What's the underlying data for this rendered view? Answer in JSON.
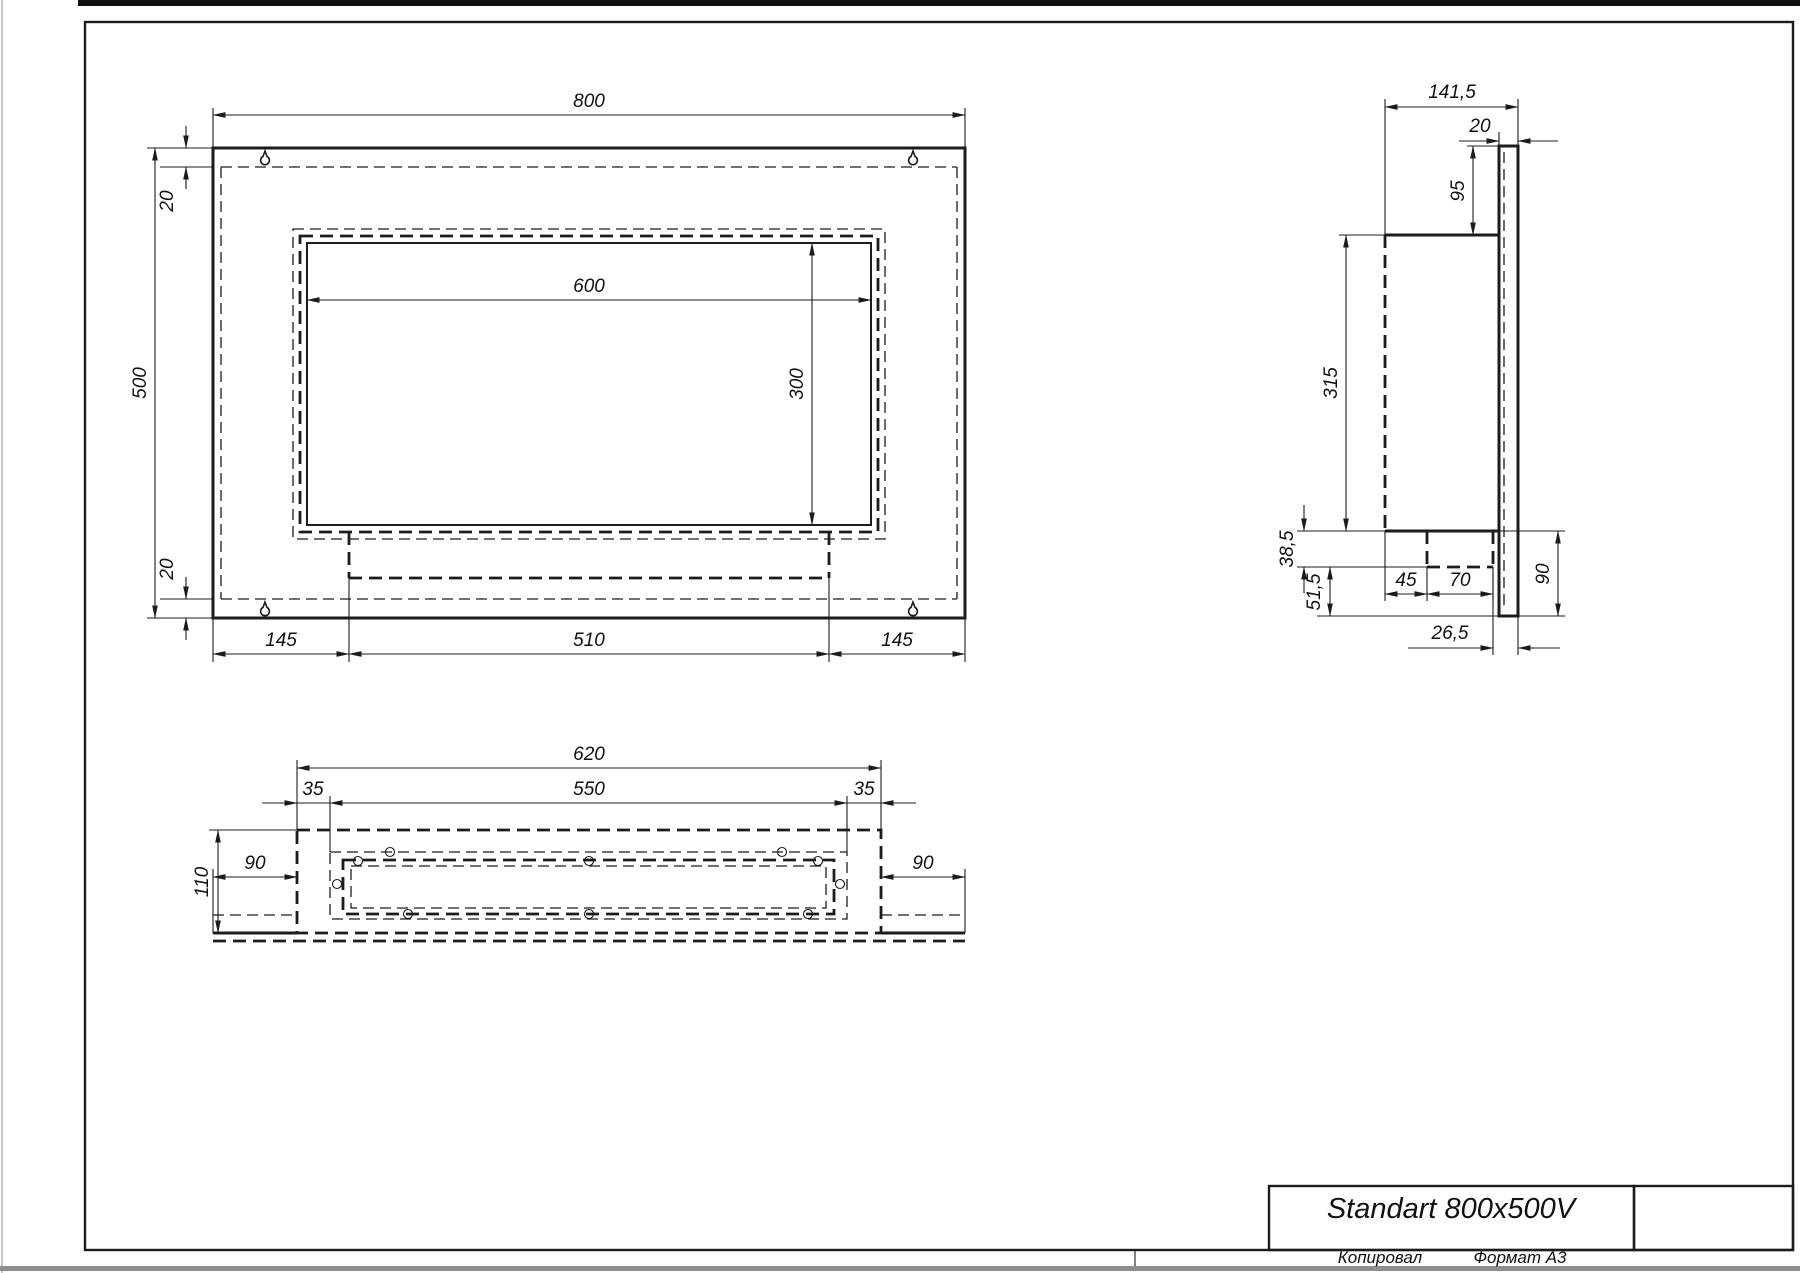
{
  "drawing": {
    "type": "technical-drawing",
    "sheet_color": "#ffffff",
    "line_color": "#1c1c1c"
  },
  "front_view": {
    "overall_width": "800",
    "overall_height": "500",
    "top_inset": "20",
    "bottom_inset": "20",
    "opening_width": "600",
    "opening_height": "300",
    "bottom_left_margin": "145",
    "bottom_center_span": "510",
    "bottom_right_margin": "145"
  },
  "side_view": {
    "overall_depth": "141,5",
    "back_panel_thickness": "20",
    "panel_top_extension": "95",
    "body_height": "315",
    "tray_depth": "38,5",
    "panel_bottom_drop": "51,5",
    "tray_offset": "45",
    "tray_width": "70",
    "panel_bottom_extension": "90",
    "tray_to_panel": "26,5"
  },
  "bottom_view": {
    "box_width": "620",
    "left_inset": "35",
    "opening_width": "550",
    "right_inset": "35",
    "depth": "110",
    "left_flange": "90",
    "right_flange": "90"
  },
  "title_block": {
    "model": "Standart 800x500V"
  },
  "footer": {
    "copied": "Копировал",
    "format": "Формат А3"
  }
}
